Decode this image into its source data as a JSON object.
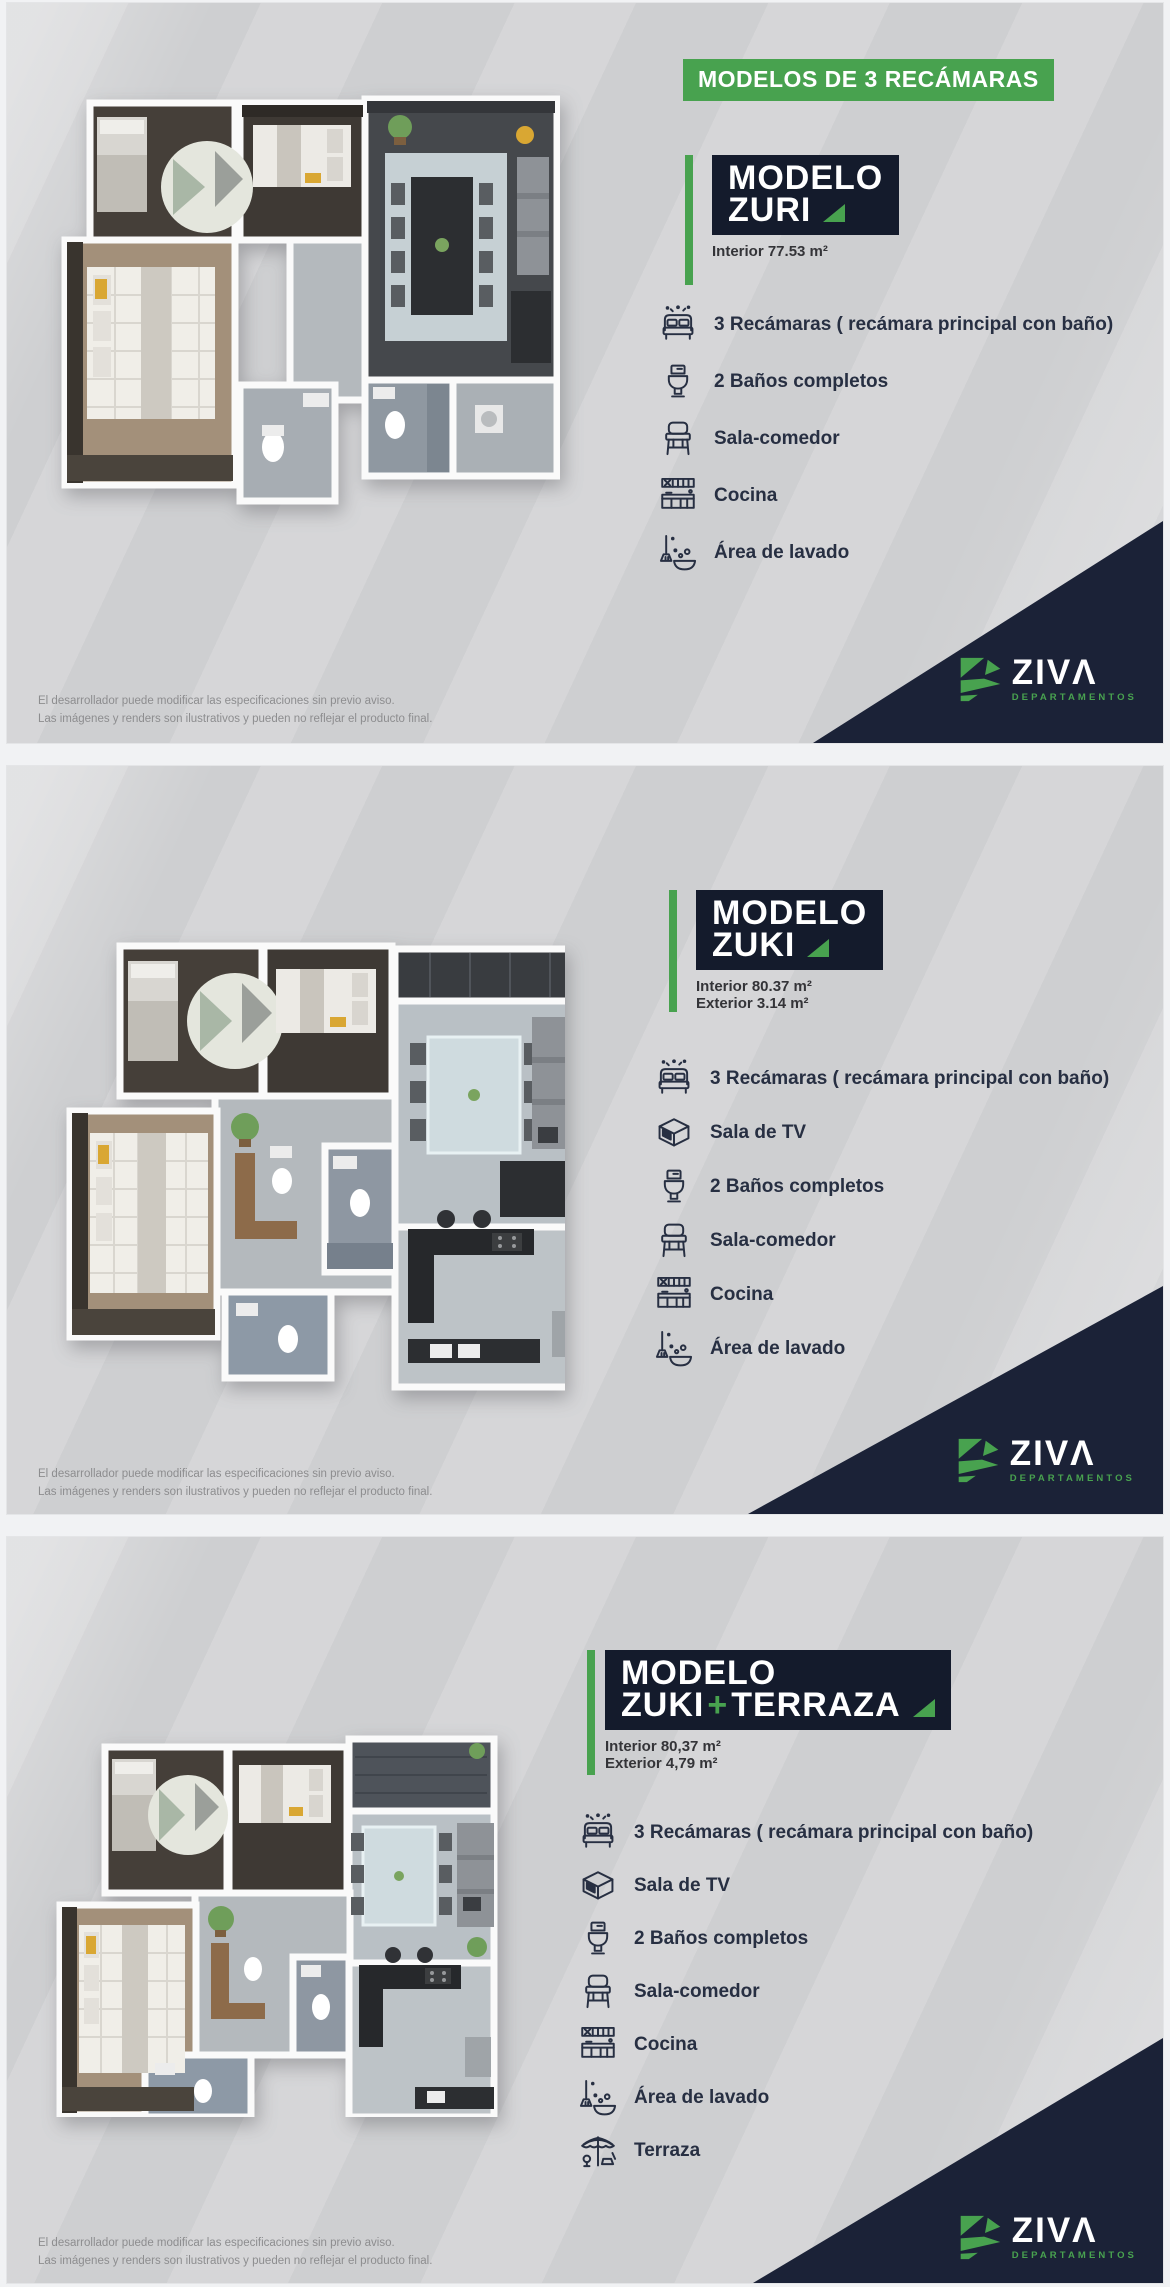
{
  "header": {
    "label": "MODELOS DE 3 RECÁMARAS"
  },
  "brand": {
    "name": "ZIVΛ",
    "tagline": "DEPARTAMENTOS"
  },
  "colors": {
    "green": "#48a24f",
    "navy_box": "#141b2c",
    "navy_corner": "#1b2237",
    "panel_bg": "#d2d3d5",
    "text": "#272f42"
  },
  "disclaimer": {
    "line1": "El desarrollador puede modificar las especificaciones sin previo aviso.",
    "line2": "Las imágenes y renders son ilustrativos y pueden no reflejar el producto final."
  },
  "models": [
    {
      "name": "ZURI",
      "title_prefix": "MODELO",
      "title_main": "ZURI",
      "areas": [
        "Interior 77.53 m²"
      ],
      "features": [
        {
          "icon": "bed-icon",
          "label": "3 Recámaras ( recámara principal con baño)"
        },
        {
          "icon": "toilet-icon",
          "label": "2 Baños completos"
        },
        {
          "icon": "chair-icon",
          "label": "Sala-comedor"
        },
        {
          "icon": "kitchen-icon",
          "label": "Cocina"
        },
        {
          "icon": "laundry-icon",
          "label": "Área de lavado"
        }
      ]
    },
    {
      "name": "ZUKI",
      "title_prefix": "MODELO",
      "title_main": "ZUKI",
      "areas": [
        "Interior 80.37 m²",
        "Exterior 3.14 m²"
      ],
      "features": [
        {
          "icon": "bed-icon",
          "label": "3 Recámaras ( recámara principal con baño)"
        },
        {
          "icon": "tv-icon",
          "label": "Sala de TV"
        },
        {
          "icon": "toilet-icon",
          "label": "2 Baños completos"
        },
        {
          "icon": "chair-icon",
          "label": "Sala-comedor"
        },
        {
          "icon": "kitchen-icon",
          "label": "Cocina"
        },
        {
          "icon": "laundry-icon",
          "label": "Área de lavado"
        }
      ]
    },
    {
      "name": "ZUKI+TERRAZA",
      "title_prefix": "MODELO",
      "title_main": "ZUKI",
      "title_plus": "+",
      "title_suffix": "TERRAZA",
      "areas": [
        "Interior 80,37 m²",
        "Exterior 4,79 m²"
      ],
      "features": [
        {
          "icon": "bed-icon",
          "label": "3 Recámaras ( recámara principal con baño)"
        },
        {
          "icon": "tv-icon",
          "label": "Sala de TV"
        },
        {
          "icon": "toilet-icon",
          "label": "2 Baños completos"
        },
        {
          "icon": "chair-icon",
          "label": "Sala-comedor"
        },
        {
          "icon": "kitchen-icon",
          "label": "Cocina"
        },
        {
          "icon": "laundry-icon",
          "label": "Área de lavado"
        },
        {
          "icon": "terrace-icon",
          "label": "Terraza"
        }
      ]
    }
  ]
}
